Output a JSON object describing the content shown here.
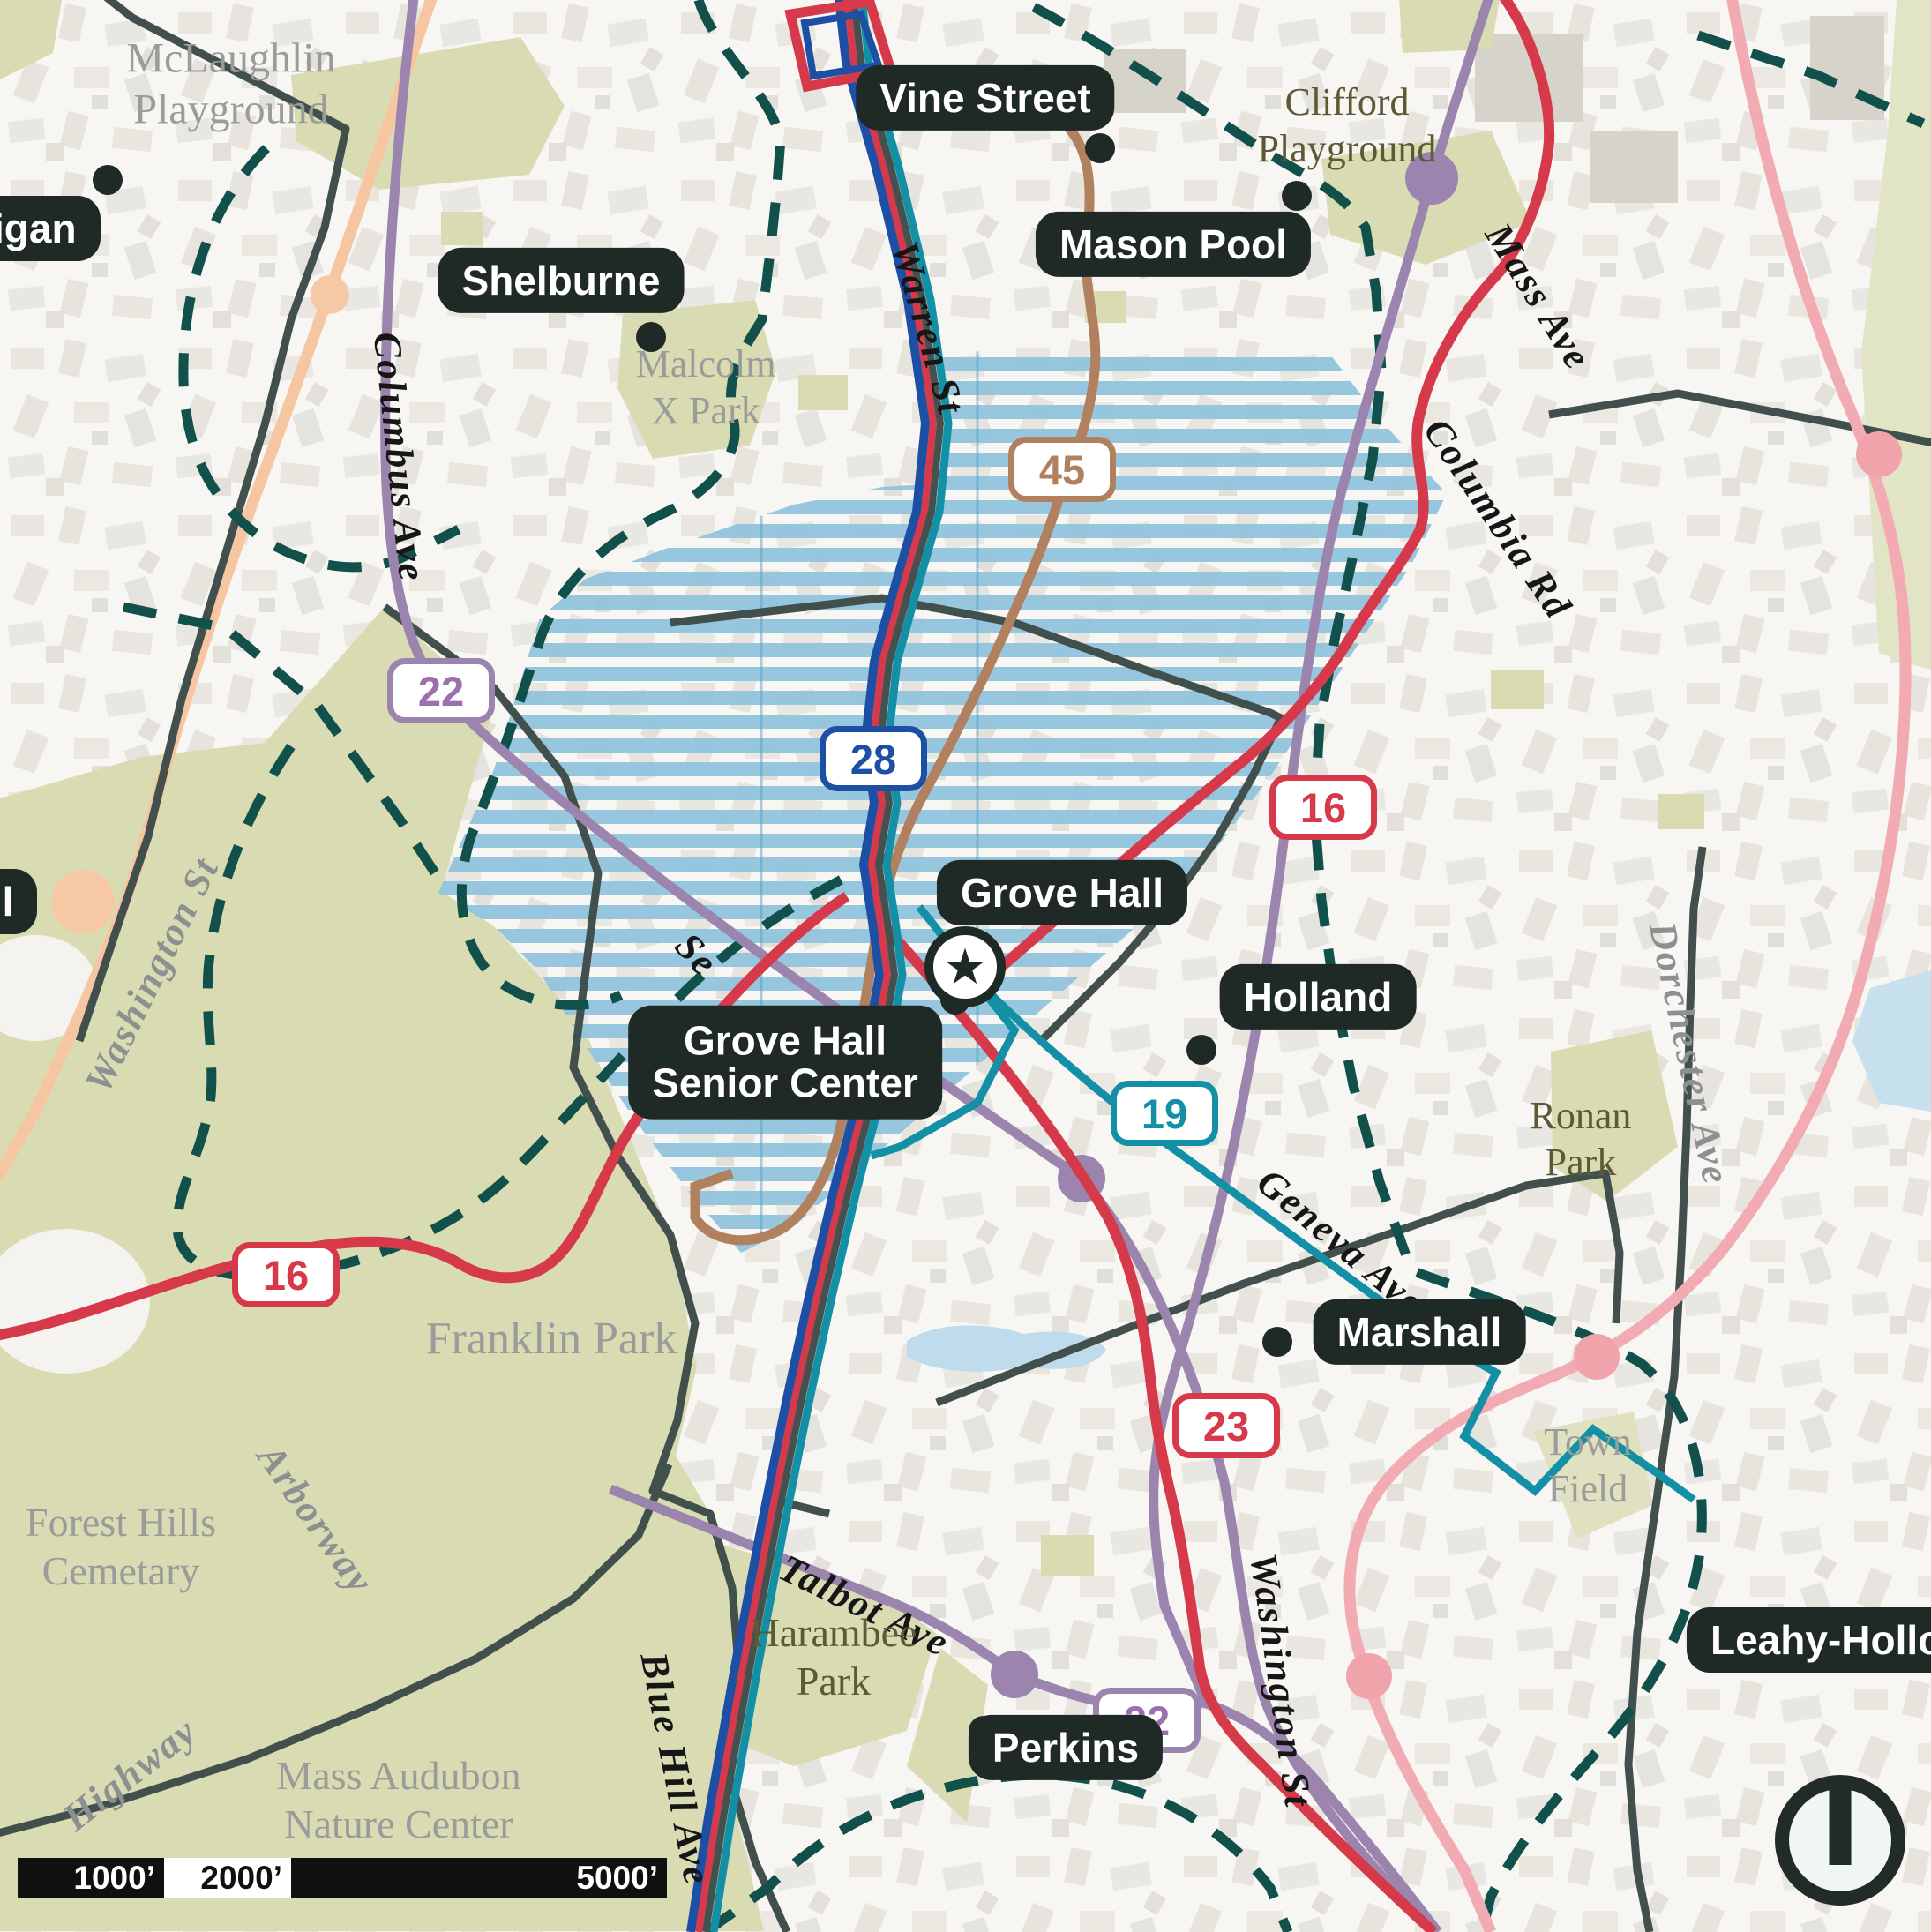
{
  "colors": {
    "route_red": "#d63a4a",
    "route_blue": "#1d50a5",
    "route_teal": "#1390a6",
    "route_purple": "#9b84ae",
    "route_brown": "#b1805f",
    "route_pink": "#f2abb2",
    "road_orange": "#f6c6a2",
    "boundary_dashed_teal": "#11504b",
    "boundary_slate": "#42504d",
    "hatch_blue": "#8ec4de",
    "park_olive": "#d9dcb2",
    "pill_background": "#1f2a27",
    "label_gray": "#8d9090",
    "label_olive": "#5c5935"
  },
  "centers": [
    {
      "id": "hennigan",
      "label": "Hennigan"
    },
    {
      "id": "hall",
      "label": "Hall"
    },
    {
      "id": "shelburne",
      "label": "Shelburne"
    },
    {
      "id": "vine-street",
      "label": "Vine Street"
    },
    {
      "id": "mason-pool",
      "label": "Mason Pool"
    },
    {
      "id": "grove-hall",
      "label": "Grove Hall"
    },
    {
      "id": "grove-hall-senior-center",
      "line1": "Grove Hall",
      "line2": "Senior Center"
    },
    {
      "id": "holland",
      "label": "Holland"
    },
    {
      "id": "marshall",
      "label": "Marshall"
    },
    {
      "id": "perkins",
      "label": "Perkins"
    },
    {
      "id": "leahy-holloran",
      "label": "Leahy-Holloran"
    }
  ],
  "streets": {
    "warren": "Warren St",
    "columbus": "Columbus Ave",
    "washington_left": "Washington St",
    "mass_ave": "Mass Ave",
    "columbia_rd": "Columbia Rd",
    "geneva": "Geneva Ave",
    "dorchester": "Dorchester Ave",
    "arborway": "Arborway",
    "talbot": "Talbot Ave",
    "blue_hill": "Blue Hill Ave",
    "washington_right": "Washington St",
    "highway": "Highway",
    "seaver_partial": "Se"
  },
  "parks": {
    "mclaughlin": {
      "line1": "McLaughlin",
      "line2": "Playground"
    },
    "clifford": {
      "line1": "Clifford",
      "line2": "Playground"
    },
    "malcolm_x": {
      "line1": "Malcolm",
      "line2": "X Park"
    },
    "franklin": {
      "line1": "Franklin Park"
    },
    "forest_hills": {
      "line1": "Forest Hills",
      "line2": "Cemetary"
    },
    "harambee": {
      "line1": "Harambee",
      "line2": "Park"
    },
    "mass_audubon": {
      "line1": "Mass Audubon",
      "line2": "Nature Center"
    },
    "ronan": {
      "line1": "Ronan",
      "line2": "Park"
    },
    "town_field": {
      "line1": "Town",
      "line2": "Field"
    }
  },
  "route_badges": [
    {
      "route": "22",
      "color": "purple"
    },
    {
      "route": "28",
      "color": "blue"
    },
    {
      "route": "45",
      "color": "brown"
    },
    {
      "route": "16",
      "color": "red"
    },
    {
      "route": "19",
      "color": "teal"
    },
    {
      "route": "16",
      "color": "red"
    },
    {
      "route": "23",
      "color": "red"
    },
    {
      "route": "22",
      "color": "purple"
    }
  ],
  "scale_bar": {
    "tick1": "1000’",
    "tick2": "2000’",
    "tick3": "5000’"
  }
}
